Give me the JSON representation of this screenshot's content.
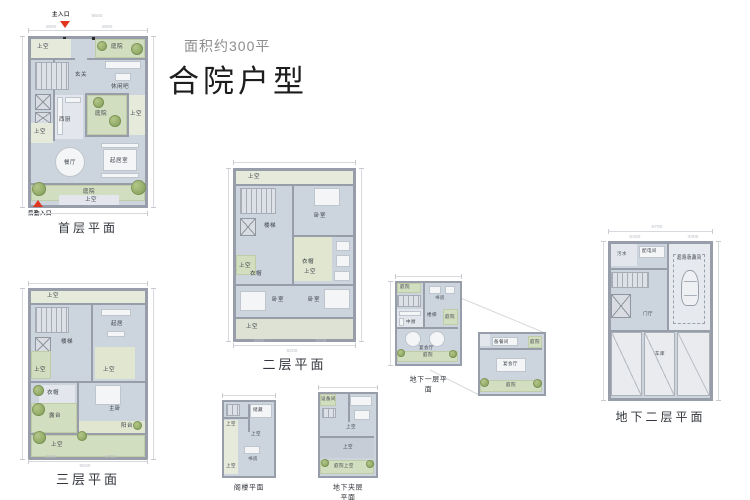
{
  "header": {
    "subtitle": "面积约300平",
    "title": "合院户型"
  },
  "markers": {
    "main_entry": "主入口",
    "service_entry": "后勤入口"
  },
  "colors": {
    "accent_red": "#e0361f",
    "wall_gray": "#989ea9",
    "floor": "#ccd4dd",
    "courtyard_green": "#d2dec0"
  },
  "plans": {
    "first": {
      "caption": "首层平面",
      "rooms": {
        "void_tl": "上空",
        "court_tr": "庭院",
        "foyer": "玄关",
        "lounge": "休闲吧",
        "west_kitchen": "西厨",
        "void_l": "上空",
        "court_c": "庭院",
        "void_r": "上空",
        "dining": "餐厅",
        "living": "起居室",
        "court_b": "庭院",
        "void_b": "上空"
      },
      "dims": {
        "w1": "4800",
        "w2": "4800",
        "total": "9600"
      }
    },
    "second": {
      "caption": "二层平面",
      "rooms": {
        "void_top": "上空",
        "stair": "楼梯",
        "bed_tr": "卧室",
        "void_c": "上空",
        "void_l": "上空",
        "cloak_l": "衣帽",
        "cloak_r": "衣帽",
        "bed_bl": "卧室",
        "bed_br": "卧室",
        "void_b": "上空"
      },
      "dims": {
        "w1": "4500",
        "w2": "4700",
        "total": "9200"
      }
    },
    "third": {
      "caption": "三层平面",
      "rooms": {
        "void_top": "上空",
        "stair": "楼梯",
        "living": "起居",
        "void_l": "上空",
        "void_c": "上空",
        "cloak": "衣帽",
        "terrace": "露台",
        "master": "主卧",
        "balcony": "阳台",
        "void_b": "上空"
      },
      "dims": {
        "w1": "2800",
        "w2": "6700",
        "total": "9500"
      }
    },
    "basement1": {
      "caption": "地下一层平面",
      "rooms": {
        "court_tl": "庭院",
        "study": "书房",
        "kitchen": "中厨",
        "stair": "楼梯",
        "court_r": "庭院",
        "banquet": "宴会厅",
        "court_b": "庭院"
      }
    },
    "basement1_inset": {
      "rooms": {
        "prep": "备餐间",
        "court_tr": "庭院",
        "banquet": "宴会厅",
        "court_b": "庭院"
      }
    },
    "basement2": {
      "caption": "地下二层平面",
      "rooms": {
        "sewage": "污水",
        "power": "配电间",
        "supercar": "超跑收藏间",
        "foyer": "门厅",
        "garage": "车库"
      },
      "dims": {
        "w1": "6400",
        "w2": "3300",
        "total": "9700"
      }
    },
    "attic": {
      "caption": "阁楼平面",
      "rooms": {
        "void_tl": "上空",
        "storage": "储藏",
        "void_c": "上空",
        "study": "书房",
        "void_b": "上空"
      }
    },
    "mezzanine": {
      "caption": "地下夹层平面",
      "rooms": {
        "equipment": "设备间",
        "void_c": "上空",
        "void_garage": "上空",
        "court_b": "庭院上空"
      }
    }
  }
}
